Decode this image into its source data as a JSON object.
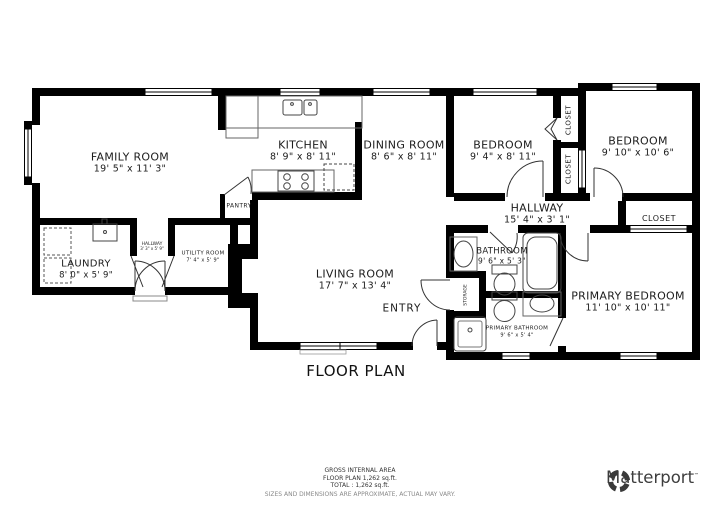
{
  "title": "FLOOR PLAN",
  "rooms": [
    {
      "name": "FAMILY ROOM",
      "dims": "19' 5\" x 11' 3\""
    },
    {
      "name": "KITCHEN",
      "dims": "8' 9\" x 8' 11\""
    },
    {
      "name": "DINING ROOM",
      "dims": "8' 6\" x 8' 11\""
    },
    {
      "name": "BEDROOM",
      "dims": "9' 4\" x 8' 11\""
    },
    {
      "name": "BEDROOM",
      "dims": "9' 10\" x 10' 6\""
    },
    {
      "name": "HALLWAY",
      "dims": "15' 4\" x 3' 1\""
    },
    {
      "name": "LIVING ROOM",
      "dims": "17' 7\" x 13' 4\""
    },
    {
      "name": "PRIMARY BEDROOM",
      "dims": "11' 10\" x 10' 11\""
    },
    {
      "name": "BATHROOM",
      "dims": "9' 6\" x 5' 3\""
    },
    {
      "name": "PRIMARY BATHROOM",
      "dims": "9' 6\" x 5' 4\""
    },
    {
      "name": "LAUNDRY",
      "dims": "8' 0\" x 5' 9\""
    },
    {
      "name": "HALLWAY",
      "dims": "3' 3\" x 5' 9\""
    },
    {
      "name": "UTILITY ROOM",
      "dims": "7' 4\" x 5' 9\""
    }
  ],
  "labels": {
    "pantry": "PANTRY",
    "storage": "STORAGE",
    "closet_a": "CLOSET",
    "closet_b": "CLOSET",
    "closet_c": "CLOSET",
    "entry": "ENTRY"
  },
  "footer": {
    "line1": "GROSS INTERNAL AREA",
    "line2": "FLOOR PLAN 1,262 sq.ft.",
    "line3": "TOTAL :  1,262 sq.ft.",
    "disclaimer": "SIZES AND DIMENSIONS ARE APPROXIMATE, ACTUAL MAY VARY."
  },
  "brand": {
    "name": "Matterport",
    "mark": "™"
  },
  "colors": {
    "wall": "#000000",
    "fixture": "#444444",
    "muted": "#888888",
    "text": "#1c1c1c",
    "brand": "#3d3d3d"
  }
}
